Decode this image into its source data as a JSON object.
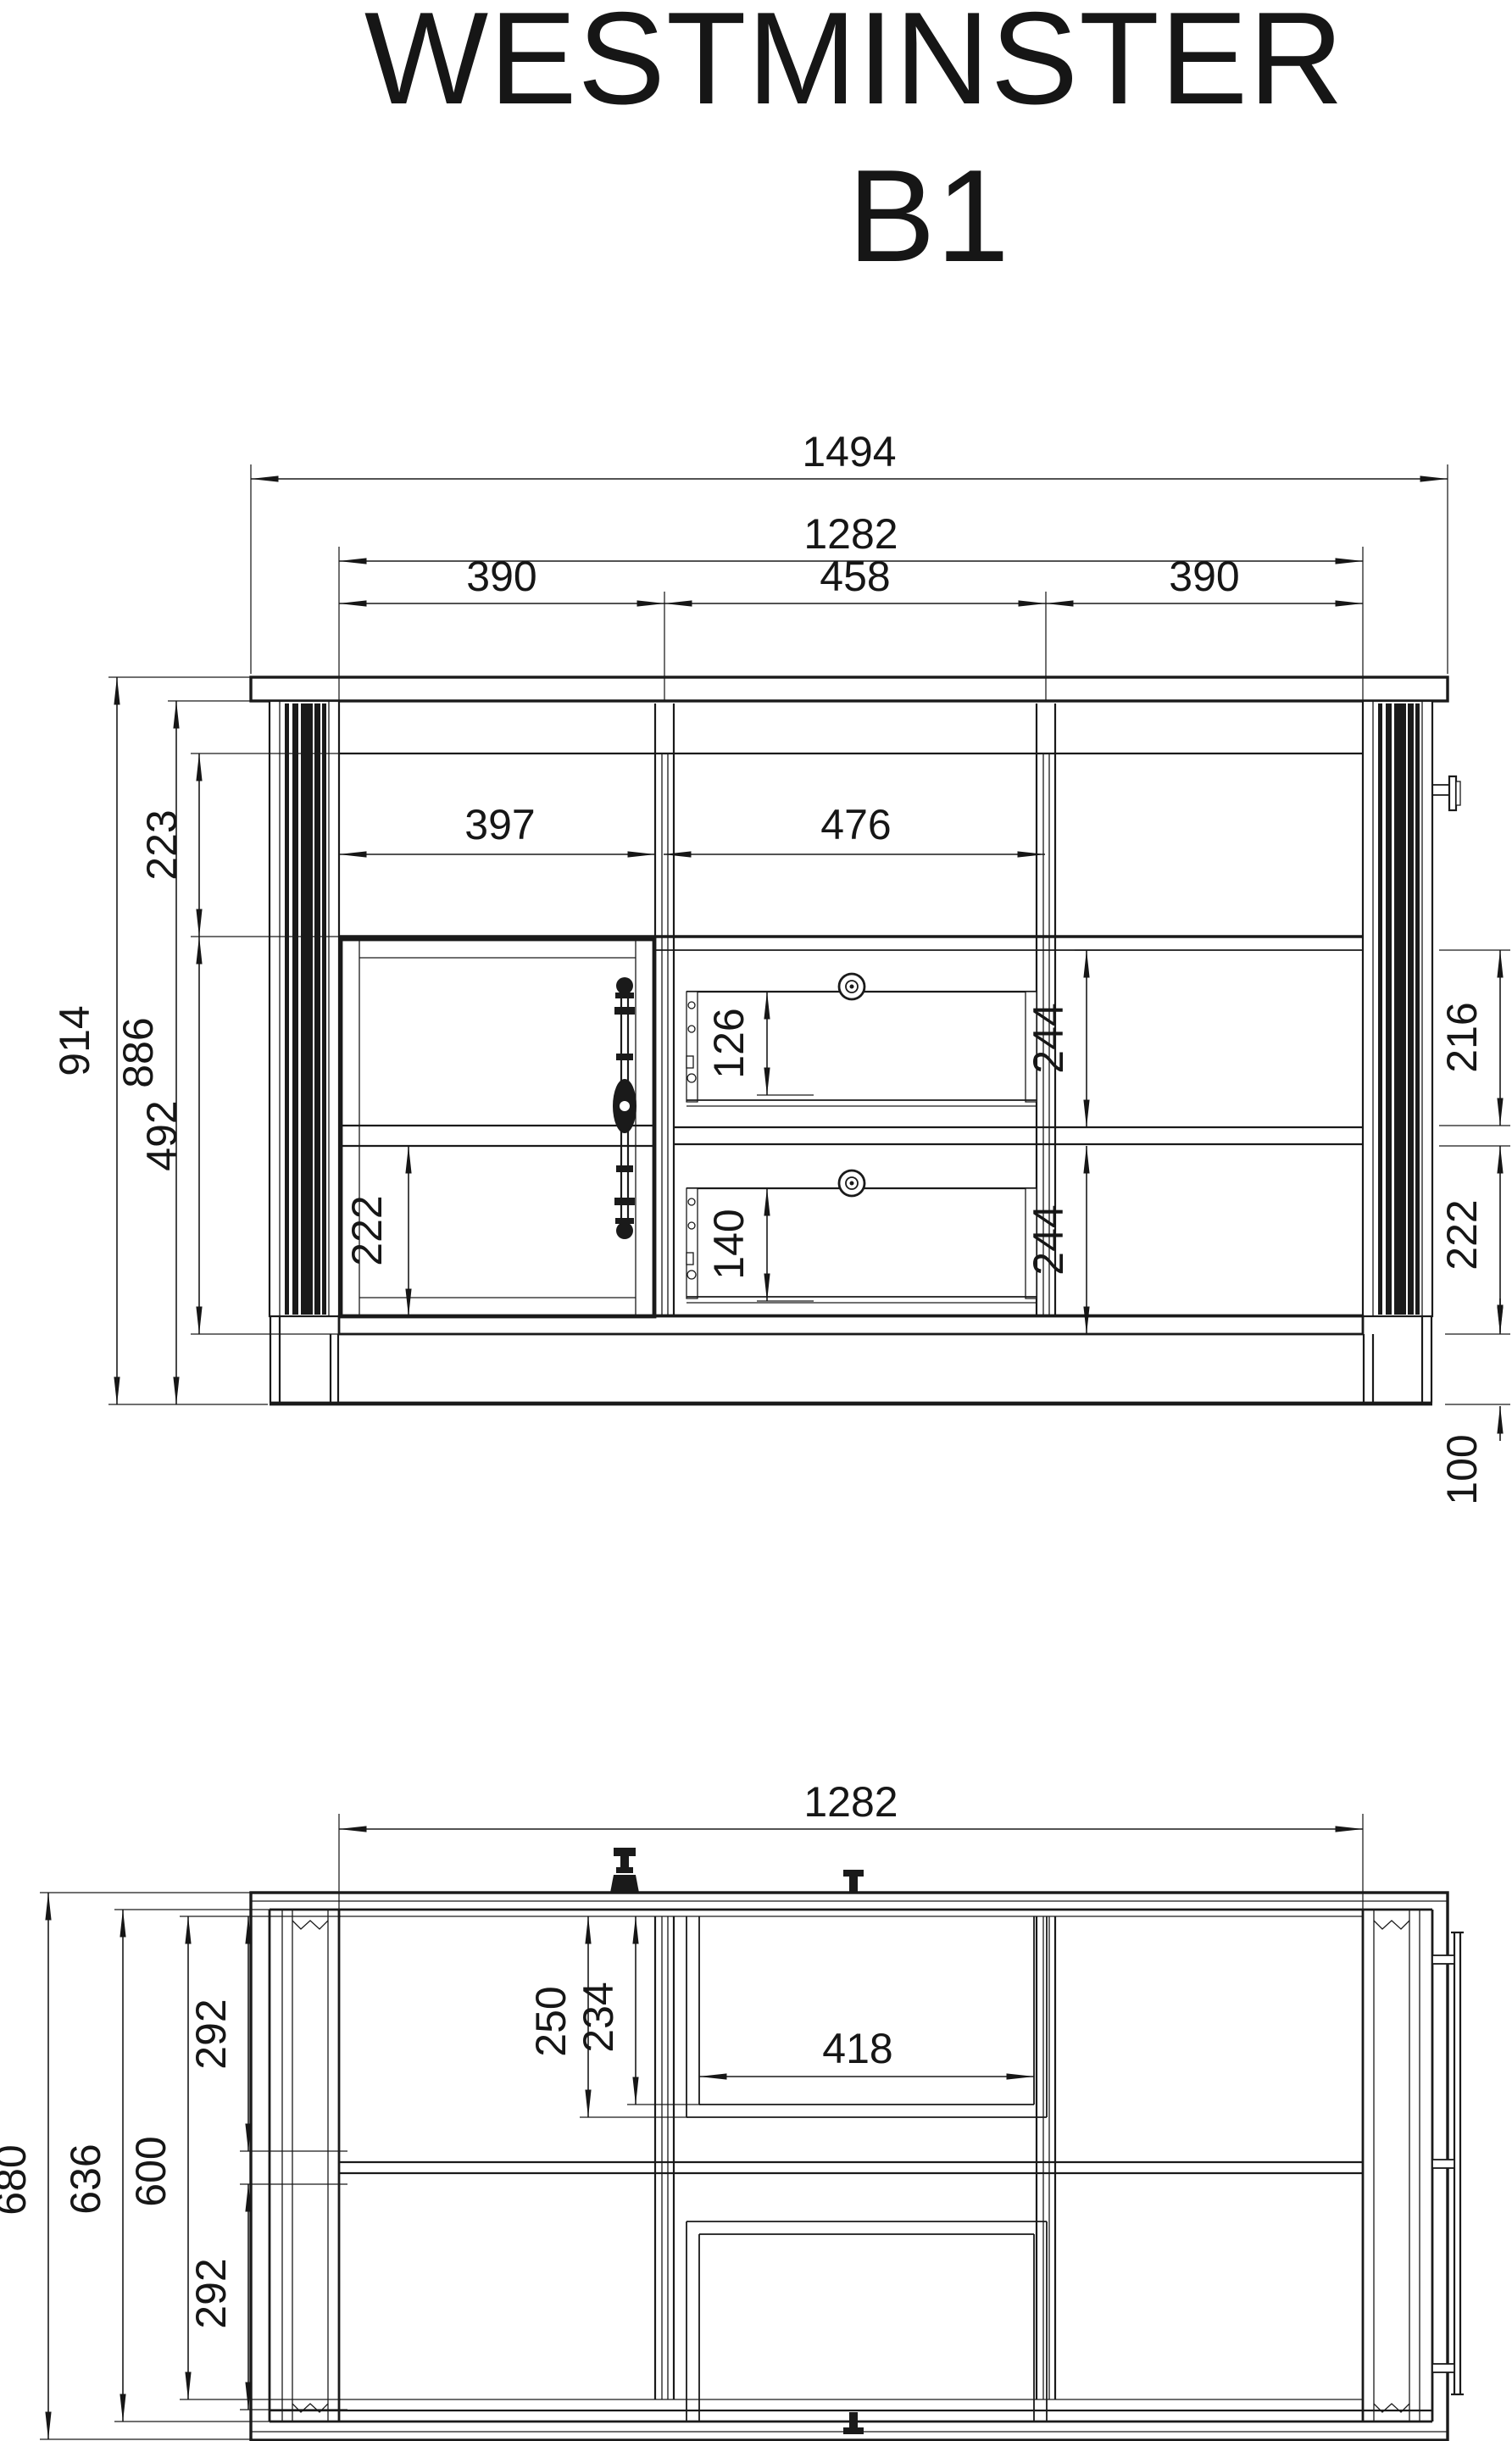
{
  "title": {
    "line1": "WESTMINSTER",
    "line2": "B1"
  },
  "front_view": {
    "dimensions": {
      "total_width": "1494",
      "inner_width": "1282",
      "section_left": "390",
      "section_center": "458",
      "section_right": "390",
      "left_opening_width": "397",
      "center_opening_width": "476",
      "total_height": "914",
      "body_height": "886",
      "top_niche_height": "223",
      "door_height": "492",
      "door_lower_panel_height": "222",
      "upper_drawer_height": "126",
      "lower_drawer_height": "140",
      "right_upper_compartment": "244",
      "right_lower_compartment": "244",
      "side_upper_height": "216",
      "side_lower_height": "222",
      "plinth_height": "100"
    }
  },
  "plan_view": {
    "dimensions": {
      "inner_width": "1282",
      "total_depth": "680",
      "body_depth": "636",
      "inner_depth": "600",
      "upper_half_depth": "292",
      "lower_half_depth": "292",
      "drawer_outer_depth": "250",
      "drawer_inner_depth": "234",
      "drawer_inner_width": "418"
    }
  }
}
